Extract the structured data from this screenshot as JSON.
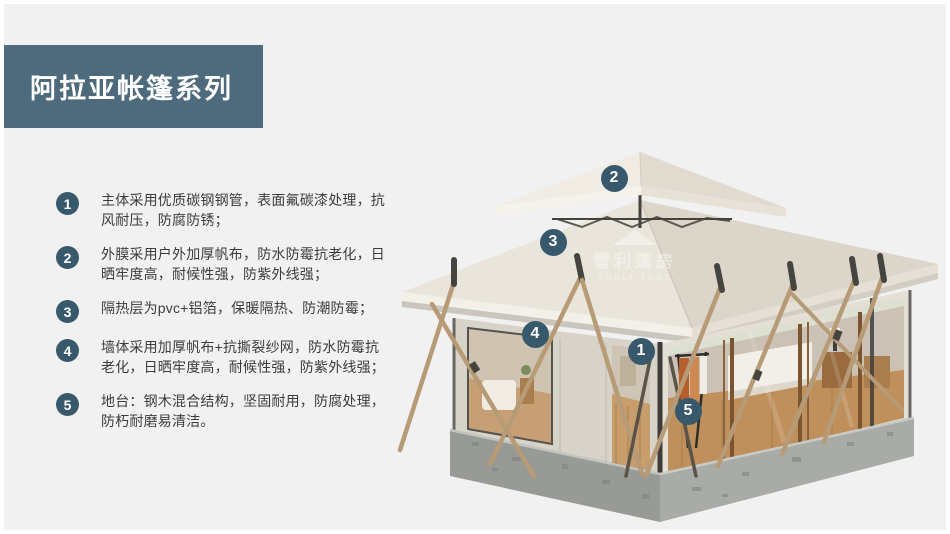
{
  "header": {
    "title": "阿拉亚帐篷系列"
  },
  "features": [
    {
      "num": "1",
      "text": "主体采用优质碳钢钢管，表面氟碳漆处理，抗风耐压，防腐防锈；"
    },
    {
      "num": "2",
      "text": "外膜采用户外加厚帆布，防水防霉抗老化，日晒牢度高，耐候性强，防紫外线强；"
    },
    {
      "num": "3",
      "text": "隔热层为pvc+铝箔，保暖隔热、防潮防霉；"
    },
    {
      "num": "4",
      "text": "墙体采用加厚帆布+抗撕裂纱网，防水防霉抗老化，日晒牢度高，耐候性强，防紫外线强；"
    },
    {
      "num": "5",
      "text": "地台：钢木混合结构，坚固耐用，防腐处理，防朽耐磨易清洁。"
    }
  ],
  "callouts": [
    {
      "num": "2",
      "x": 222,
      "y": 36
    },
    {
      "num": "3",
      "x": 161,
      "y": 100
    },
    {
      "num": "4",
      "x": 143,
      "y": 192
    },
    {
      "num": "1",
      "x": 249,
      "y": 209
    },
    {
      "num": "5",
      "x": 296,
      "y": 269
    }
  ],
  "watermark": {
    "cn": "雪利篷房",
    "en": "YUELI TENT"
  },
  "colors": {
    "accent": "#37596B",
    "header_bg": "#4E6B7D",
    "background": "#F1F1F2"
  }
}
